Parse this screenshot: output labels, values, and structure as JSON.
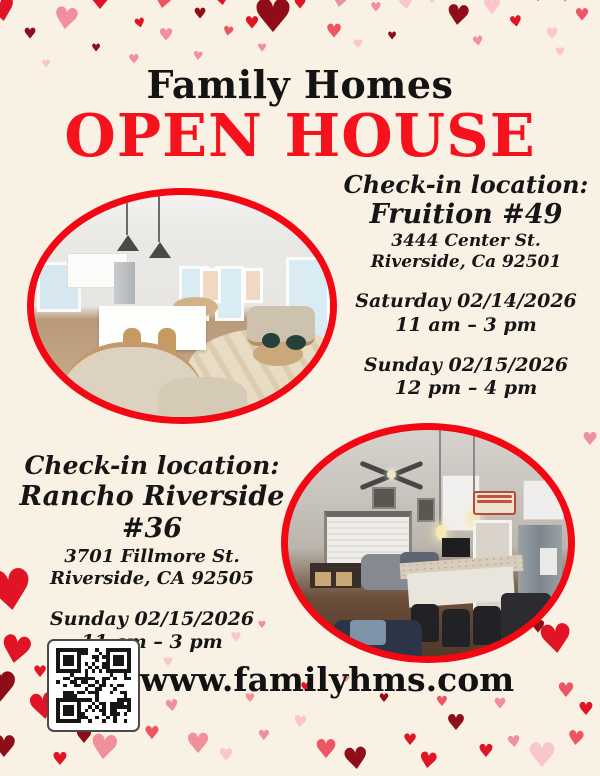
{
  "flyer": {
    "brand": "Family Homes",
    "headline": "OPEN HOUSE",
    "website": "www.familyhms.com"
  },
  "location_fruition": {
    "heading": "Check-in location:",
    "name": "Fruition #49",
    "address1": "3444 Center St.",
    "address2": "Riverside, Ca 92501",
    "sessions": [
      {
        "date": "Saturday 02/14/2026",
        "time": "11 am – 3 pm"
      },
      {
        "date": "Sunday 02/15/2026",
        "time": "12 pm – 4 pm"
      }
    ]
  },
  "location_rancho": {
    "heading": "Check-in location:",
    "name": "Rancho Riverside #36",
    "address1": "3701 Fillmore St.",
    "address2": "Riverside, CA 92505",
    "sessions": [
      {
        "date": "Sunday 02/15/2026",
        "time": "11 am – 3 pm"
      }
    ]
  },
  "photos": [
    {
      "name": "staged-open-concept-kitchen-living-room"
    },
    {
      "name": "furnished-living-room-with-breakfast-bar-kitchen"
    }
  ],
  "icons": {
    "heart": "♥",
    "qr": "qr-code"
  },
  "colors": {
    "background": "#FAF1E5",
    "headline_red": "#F6121D",
    "oval_border_red": "#F20713",
    "text_black": "#161616",
    "heart_palette": [
      "#E01424",
      "#8F0D18",
      "#F0909A",
      "#F8C6CB",
      "#EE5562"
    ]
  }
}
